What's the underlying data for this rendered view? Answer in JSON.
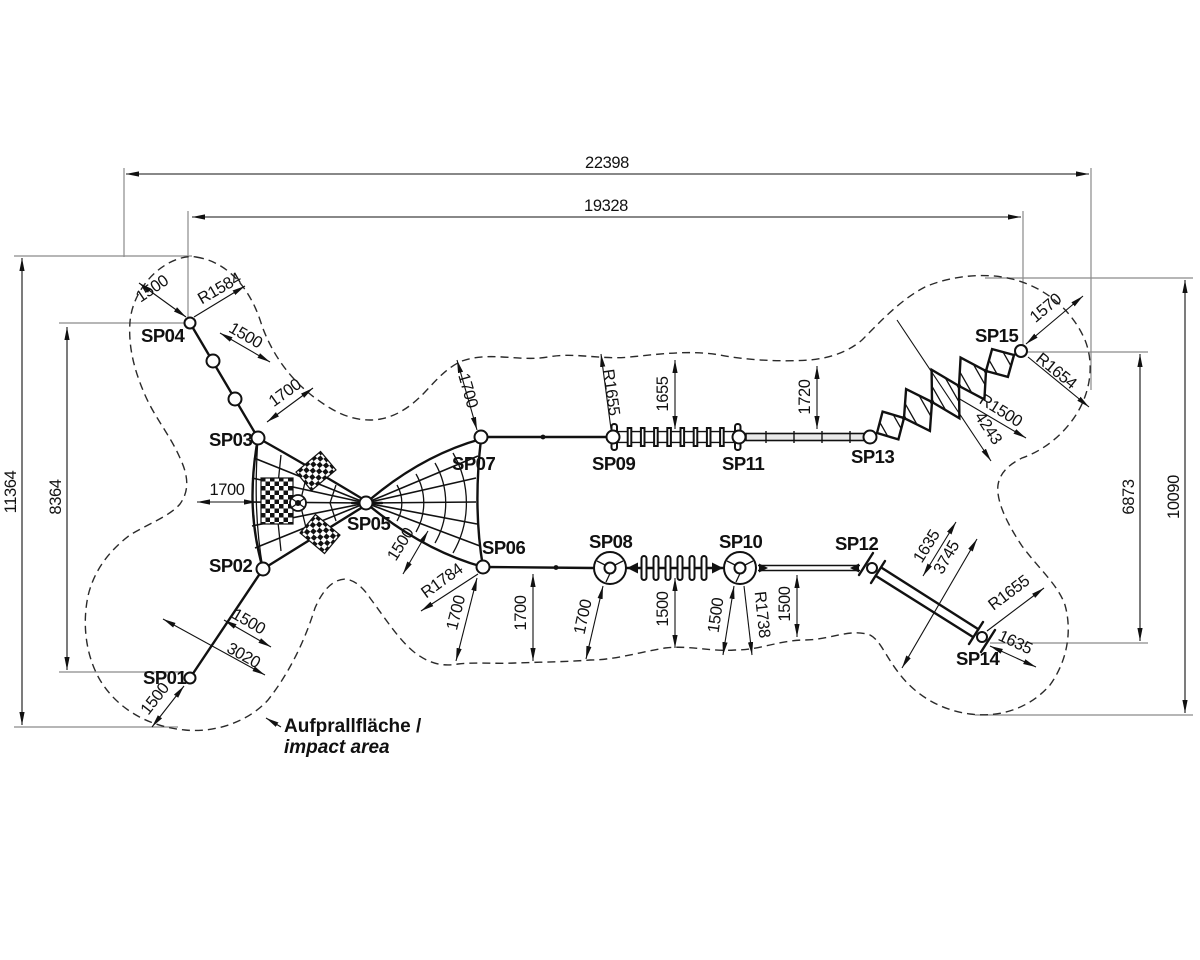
{
  "drawing": {
    "kind": "playground rope-course top view with impact area",
    "impact_area": {
      "label_de": "Aufprallfläche /",
      "label_en": "impact area"
    },
    "points": {
      "sp01": "SP01",
      "sp02": "SP02",
      "sp03": "SP03",
      "sp04": "SP04",
      "sp05": "SP05",
      "sp06": "SP06",
      "sp07": "SP07",
      "sp08": "SP08",
      "sp09": "SP09",
      "sp10": "SP10",
      "sp11": "SP11",
      "sp12": "SP12",
      "sp13": "SP13",
      "sp14": "SP14",
      "sp15": "SP15"
    },
    "dims": {
      "width_total": "22398",
      "width_inner": "19328",
      "height_left_total": "11364",
      "height_left_inner": "8364",
      "height_right_total": "10090",
      "height_right_inner": "6873",
      "sp04_clearance": "1500",
      "sp04_radius": "R1584",
      "sp04_sp03_seg1": "1500",
      "sp04_sp03_seg2": "1700",
      "net_left_clearance": "1700",
      "sp02_sp01_part": "1500",
      "sp02_sp01_total": "3020",
      "sp01_clearance": "1500",
      "sp05_edge": "1500",
      "sp06_radius": "R1784",
      "sp06_clearance": "1700",
      "mid_bottom_1": "1700",
      "sp08_clearance": "1700",
      "mid_bottom_2": "1500",
      "sp10_clearance": "1500",
      "sp10_radius": "R1738",
      "mid_bottom_3": "1500",
      "sp07_clearance": "1700",
      "sp09_radius": "R1655",
      "ladder_clearance": "1655",
      "beam_clearance": "1720",
      "sp15_clearance": "1570",
      "sp15_radius": "R1654",
      "diamond_radius": "R1500",
      "diamond_span": "4243",
      "bars_clearance": "1635",
      "bars_span": "3745",
      "sp14_radius": "R1655",
      "sp14_clearance": "1635"
    }
  }
}
